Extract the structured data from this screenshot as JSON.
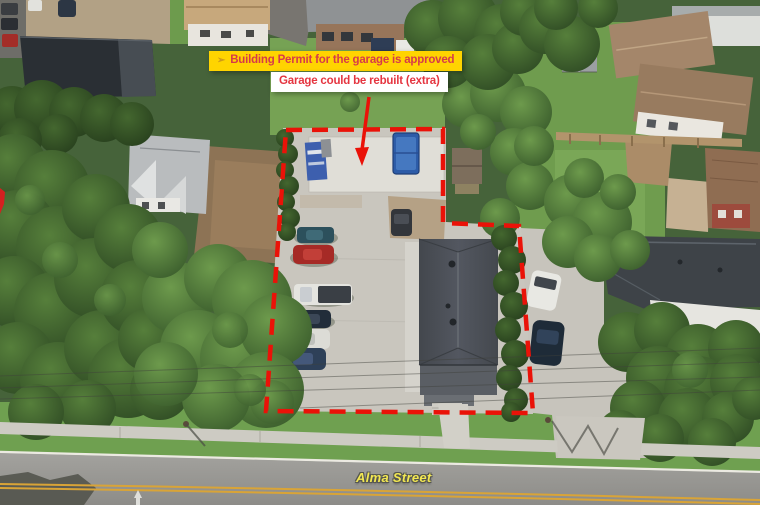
{
  "annotations": {
    "permit_banner": {
      "marker": "➢",
      "label": "Building Permit for the garage is approved",
      "bg_color": "#ffd400",
      "text_color": "#d63a4a"
    },
    "rebuild_banner": {
      "label": "Garage could be rebuilt (extra)",
      "bg_color": "#ffffff",
      "text_color": "#e53540"
    },
    "boundary": {
      "style": "dashed",
      "color": "#ea1208",
      "shape": "property-lot-outline"
    },
    "arrow": {
      "color": "#ea1208",
      "points_to": "garage-concrete-pad"
    },
    "street_label": {
      "text": "Alma Street",
      "color": "#f2e752"
    }
  }
}
